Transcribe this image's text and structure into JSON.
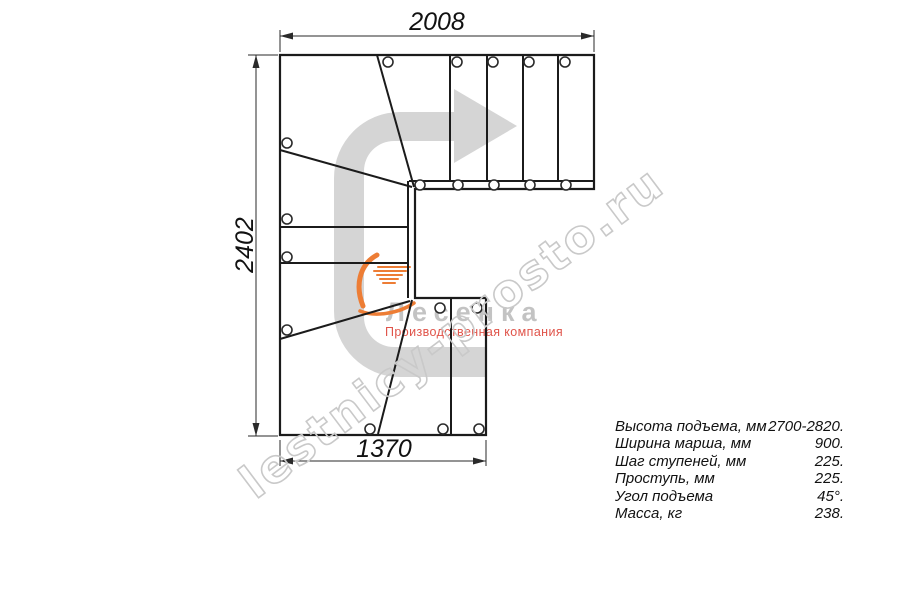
{
  "drawing": {
    "type": "stair-plan-top-view",
    "dimensions": {
      "top_width_mm": "2008",
      "left_height_mm": "2402",
      "bottom_width_mm": "1370"
    }
  },
  "watermark": {
    "text": "lestnicy-prosto.ru"
  },
  "logo": {
    "name": "Лесенка",
    "tagline": "Производственная компания",
    "flame_icon": "flame-swoosh-icon"
  },
  "specs": {
    "rows": [
      {
        "label": "Высота подъема, мм",
        "value": "2700-2820."
      },
      {
        "label": "Ширина марша, мм",
        "value": "900."
      },
      {
        "label": "Шаг ступеней, мм",
        "value": "225."
      },
      {
        "label": "Проступь, мм",
        "value": "225."
      },
      {
        "label": "Угол подъема",
        "value": "45°."
      },
      {
        "label": "Масса, кг",
        "value": "238."
      }
    ]
  },
  "colors": {
    "line": "#1b1b1b",
    "dimension": "#2a2a2a",
    "direction_arrow": "#d5d5d5",
    "watermark_outline": "#c9c9c9",
    "logo_text": "#c3c3c3",
    "tagline": "#e0544a",
    "flame": "#ed7d35",
    "background": "#ffffff"
  }
}
